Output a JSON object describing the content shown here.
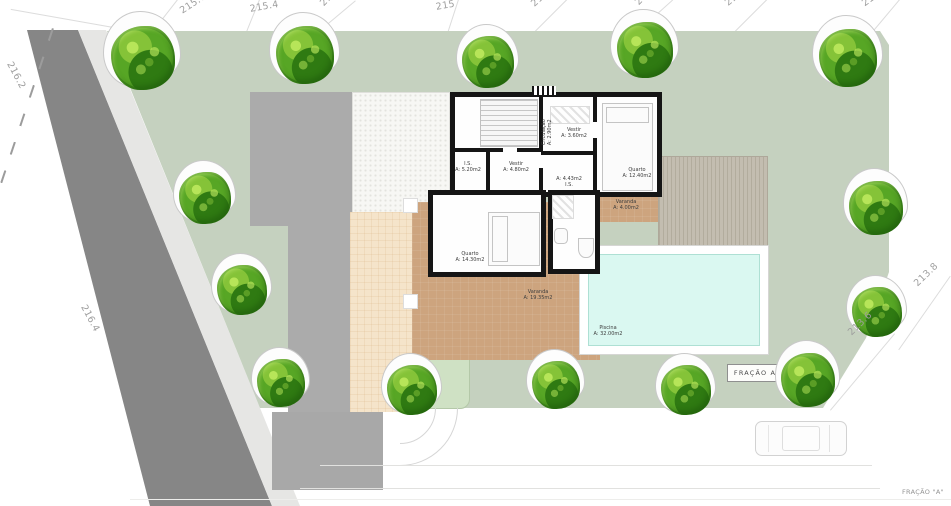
{
  "site": {
    "fracao_box_label": "FRAÇÃO A",
    "corner_note": "FRAÇÃO \"A\""
  },
  "colors": {
    "lawn": "#c5d1bf",
    "road": "#868686",
    "shoulder": "#e6e6e4",
    "terrace_tan": "#cda47e",
    "terrace_cream": "#f5e4ca",
    "deck": "#c3bdb0",
    "pool_water": "#daf8f1",
    "house_wall": "#151515",
    "tree_green": "#57a625"
  },
  "contour_labels": [
    {
      "text": "216.2",
      "x": 14,
      "y": 60,
      "rot": 62
    },
    {
      "text": "216.4",
      "x": 88,
      "y": 303,
      "rot": 62
    },
    {
      "text": "215.6",
      "x": 178,
      "y": 7,
      "rot": -33
    },
    {
      "text": "215.4",
      "x": 249,
      "y": 4,
      "rot": -10
    },
    {
      "text": "215.2",
      "x": 318,
      "y": 1,
      "rot": -46
    },
    {
      "text": "215",
      "x": 435,
      "y": 2,
      "rot": -10
    },
    {
      "text": "214.8",
      "x": 529,
      "y": 1,
      "rot": -42
    },
    {
      "text": "214.6",
      "x": 633,
      "y": 0,
      "rot": -46
    },
    {
      "text": "214.4",
      "x": 723,
      "y": 0,
      "rot": -40
    },
    {
      "text": "214.2",
      "x": 860,
      "y": 0,
      "rot": -36
    },
    {
      "text": "213.8",
      "x": 912,
      "y": 281,
      "rot": -44
    },
    {
      "text": "213.6",
      "x": 846,
      "y": 330,
      "rot": -44
    }
  ],
  "room_labels": [
    {
      "text": "Circulação\nA: 2.90m2",
      "cx": 547,
      "cy": 133,
      "rot": -90
    },
    {
      "text": "Vestir\nA: 3.60m2",
      "cx": 574,
      "cy": 134,
      "rot": 0
    },
    {
      "text": "Quarto\nA: 12.40m2",
      "cx": 637,
      "cy": 174,
      "rot": 0
    },
    {
      "text": "I.S.\nA: 5.20m2",
      "cx": 468,
      "cy": 168,
      "rot": 0
    },
    {
      "text": "Vestir\nA: 4.80m2",
      "cx": 516,
      "cy": 168,
      "rot": 0
    },
    {
      "text": "A: 4.43m2\nI.S.",
      "cx": 569,
      "cy": 183,
      "rot": 0
    },
    {
      "text": "Quarto\nA: 14.30m2",
      "cx": 470,
      "cy": 258,
      "rot": 0
    },
    {
      "text": "Varanda\nA: 19.35m2",
      "cx": 538,
      "cy": 296,
      "rot": 0
    },
    {
      "text": "Varanda\nA: 4.00m2",
      "cx": 626,
      "cy": 206,
      "rot": 0
    },
    {
      "text": "Piscina\nA: 32.00m2",
      "cx": 608,
      "cy": 332,
      "rot": 0
    }
  ],
  "trees": [
    {
      "x": 143,
      "y": 58,
      "s": 64
    },
    {
      "x": 305,
      "y": 55,
      "s": 58
    },
    {
      "x": 488,
      "y": 62,
      "s": 52
    },
    {
      "x": 645,
      "y": 50,
      "s": 56
    },
    {
      "x": 848,
      "y": 58,
      "s": 58
    },
    {
      "x": 205,
      "y": 198,
      "s": 52
    },
    {
      "x": 242,
      "y": 290,
      "s": 50
    },
    {
      "x": 281,
      "y": 383,
      "s": 48
    },
    {
      "x": 412,
      "y": 390,
      "s": 50
    },
    {
      "x": 556,
      "y": 385,
      "s": 48
    },
    {
      "x": 686,
      "y": 390,
      "s": 50
    },
    {
      "x": 808,
      "y": 380,
      "s": 54
    },
    {
      "x": 876,
      "y": 208,
      "s": 54
    },
    {
      "x": 877,
      "y": 312,
      "s": 50
    }
  ]
}
